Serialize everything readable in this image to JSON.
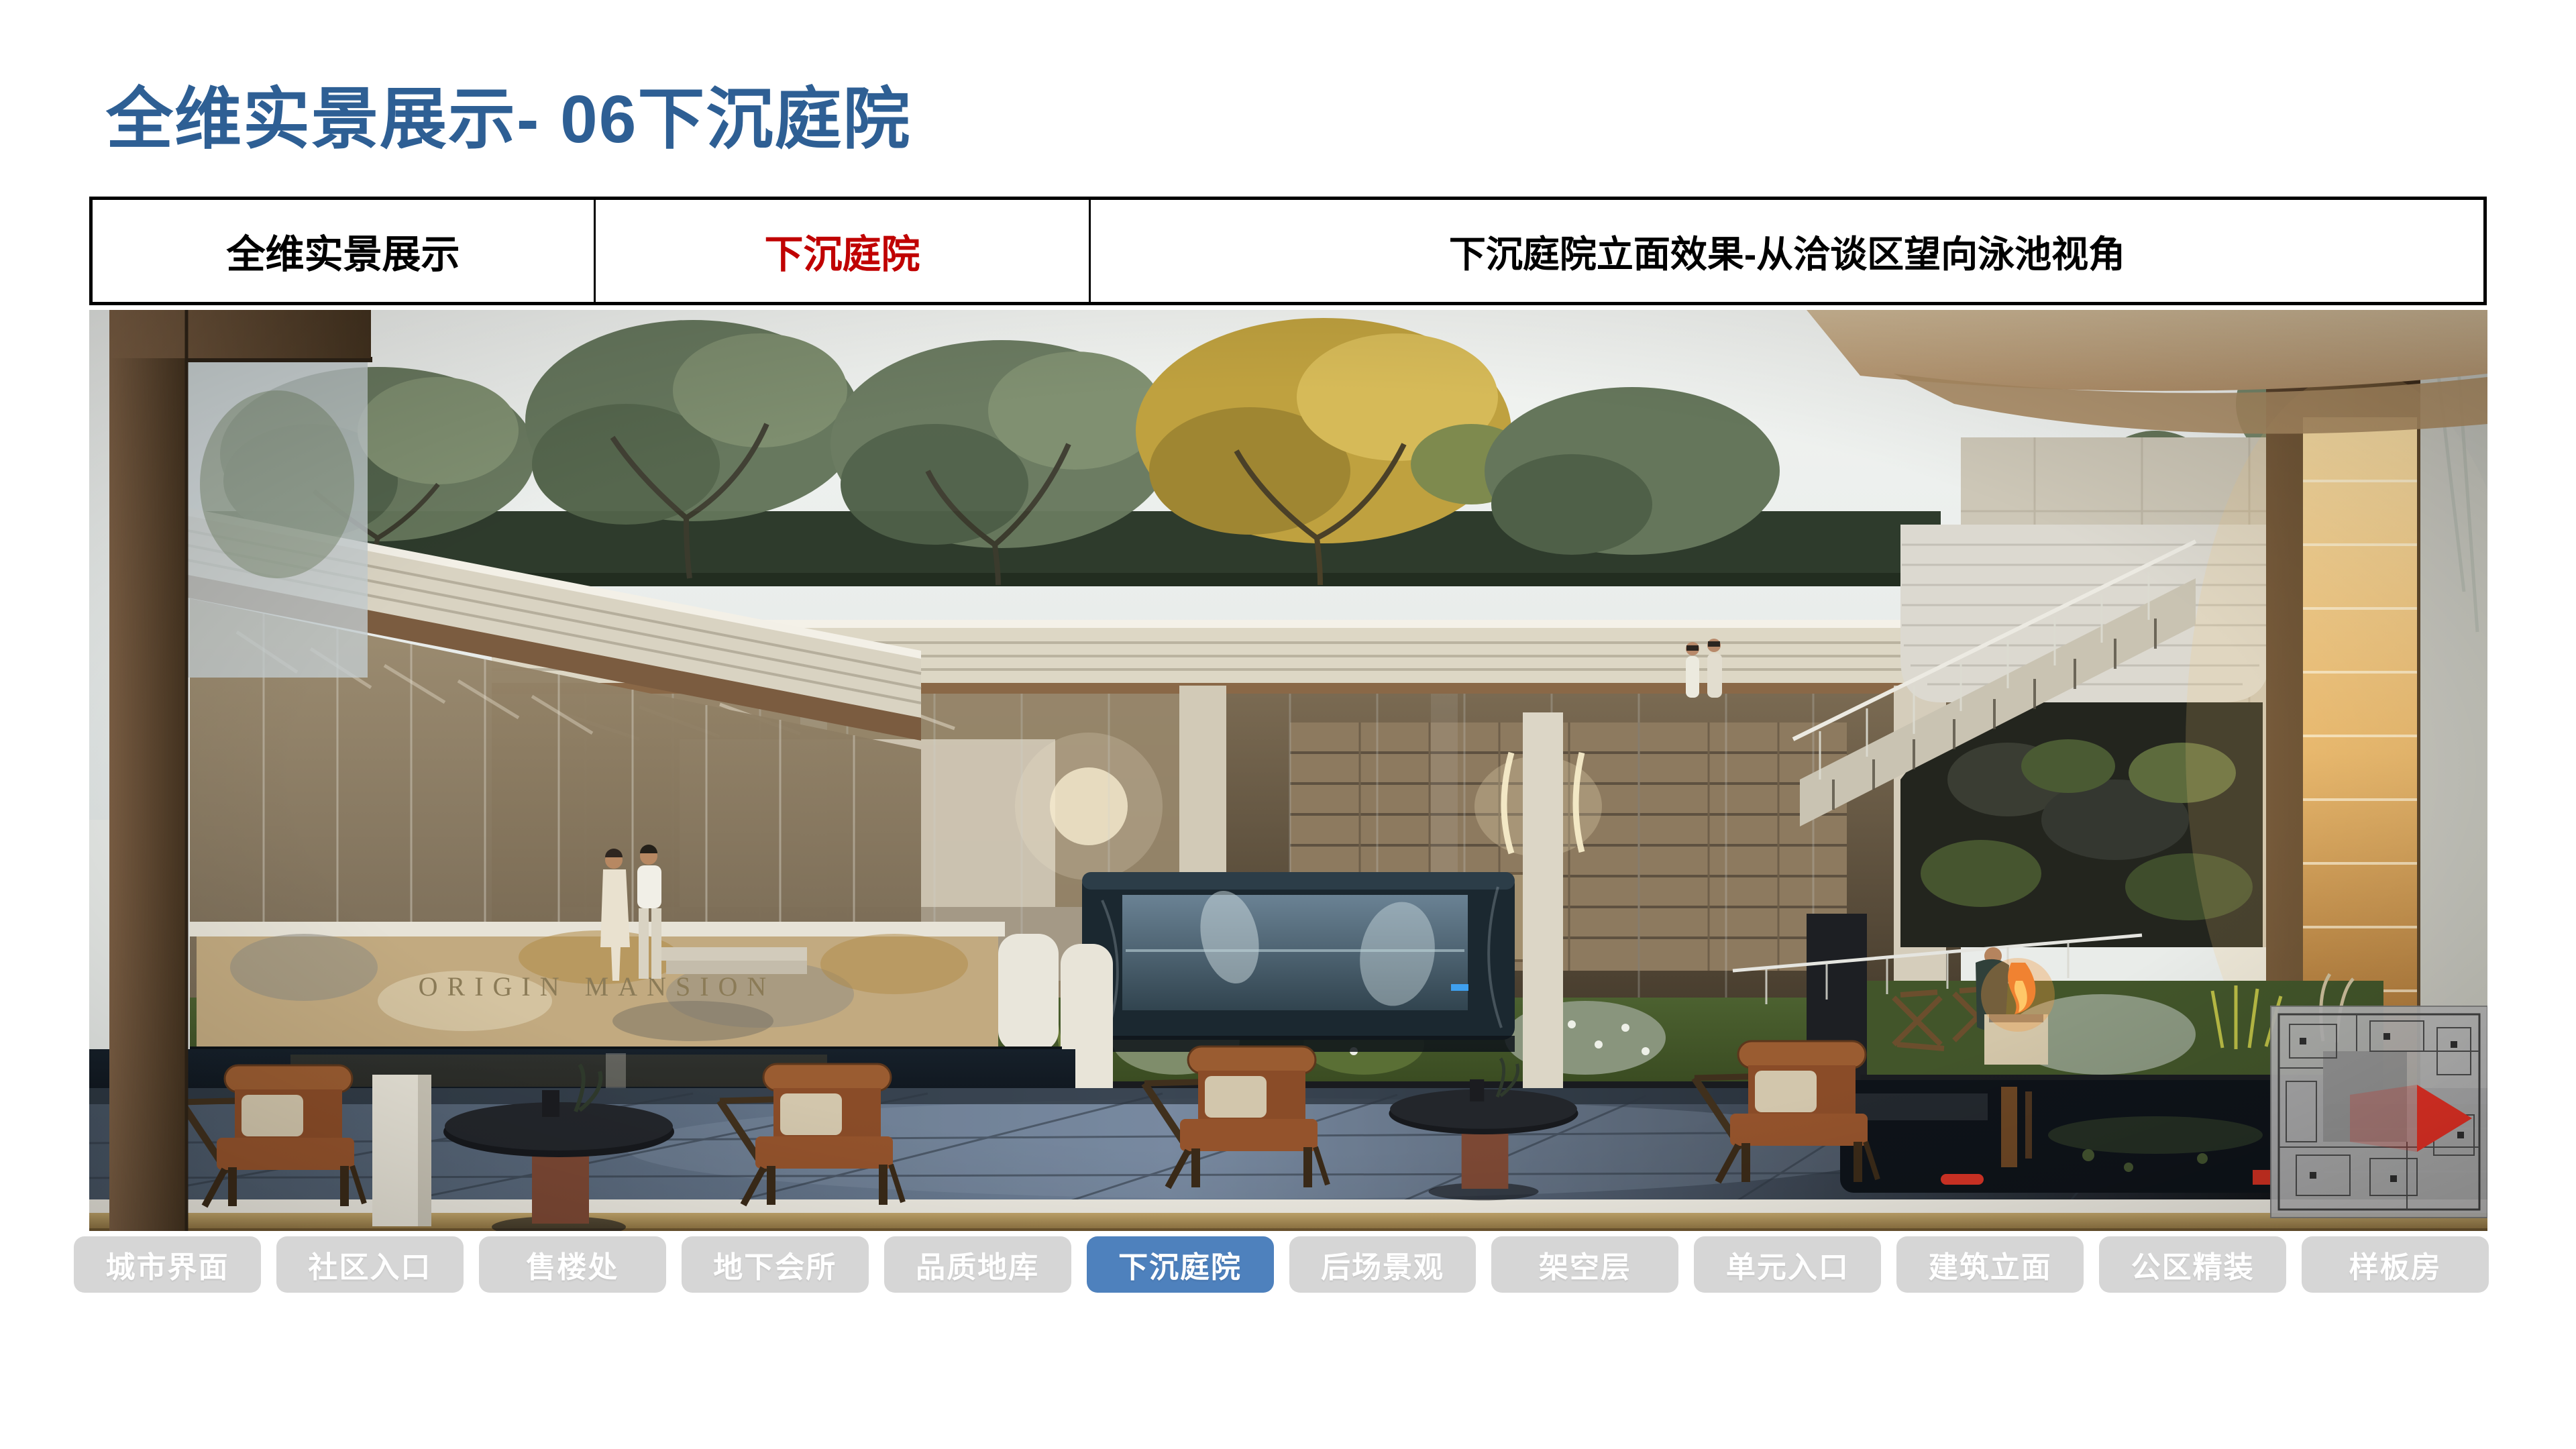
{
  "page_title": "全维实景展示- 06下沉庭院",
  "header_table": {
    "overview_label": "全维实景展示",
    "section_label": "下沉庭院",
    "caption": "下沉庭院立面效果-从洽谈区望向泳池视角"
  },
  "rendering": {
    "watermark_main": "ORIGIN MANSION",
    "watermark_small": "ORIGIN MANSION"
  },
  "tabs": [
    {
      "name": "city-interface",
      "label": "城市界面",
      "active": false
    },
    {
      "name": "community-entrance",
      "label": "社区入口",
      "active": false
    },
    {
      "name": "sales-office",
      "label": "售楼处",
      "active": false
    },
    {
      "name": "underground-club",
      "label": "地下会所",
      "active": false
    },
    {
      "name": "quality-garage",
      "label": "品质地库",
      "active": false
    },
    {
      "name": "sunken-courtyard",
      "label": "下沉庭院",
      "active": true
    },
    {
      "name": "backyard-landscape",
      "label": "后场景观",
      "active": false
    },
    {
      "name": "stilt-floor",
      "label": "架空层",
      "active": false
    },
    {
      "name": "unit-entrance",
      "label": "单元入口",
      "active": false
    },
    {
      "name": "building-facade",
      "label": "建筑立面",
      "active": false
    },
    {
      "name": "public-area-decoration",
      "label": "公区精装",
      "active": false
    },
    {
      "name": "show-flat",
      "label": "样板房",
      "active": false
    }
  ],
  "colors": {
    "title_blue": "#2E5F94",
    "accent_red": "#C00000",
    "tab_active_bg": "#4E81BD",
    "tab_inactive_bg": "#D6D6D6",
    "tab_text": "#FFFFFF"
  }
}
